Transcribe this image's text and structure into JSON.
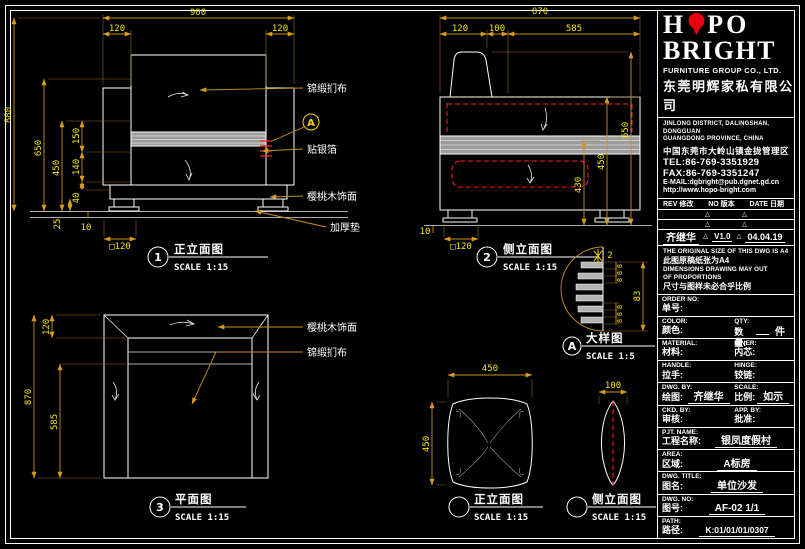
{
  "colors": {
    "background": "#000000",
    "line": "#ffffff",
    "dimension_text": "#f5e400",
    "dimension_line": "#c9921c",
    "hidden_line": "#ff2222",
    "band_gray": "#b3b3b3",
    "logo_red": "#e8000d",
    "detail_marker": "#ffd400"
  },
  "brand": {
    "logo_left": "H",
    "logo_right": "PO",
    "logo_line2": "BRIGHT",
    "company_en": "FURNITURE GROUP CO., LTD.",
    "company_cn": "东莞明辉家私有限公司"
  },
  "contact": {
    "addr_en1": "JINLONG DISTRICT, DALINGSHAN, DONGGUAN",
    "addr_en2": "GUANGDONG PROVINCE, CHINA",
    "addr_cn": "中国东莞市大岭山镇金拢管理区",
    "tel": "TEL:86-769-3351929",
    "fax": "FAX:86-769-3351247",
    "email": "E-MAIL:dgbright@pub.dgnet.gd.cn",
    "web": "http://www.hopo-bright.com"
  },
  "revision": {
    "header_rev": "REV 修改",
    "header_no": "NO 版本",
    "header_date": "DATE 日期",
    "name": "齐继华",
    "version": "V1.0",
    "date": "04.04.19"
  },
  "notes": {
    "en1": "THE ORIGINAL SIZE OF THIS DWG IS A4",
    "cn1": "此图原稿纸张为A4",
    "en2": "DIMENSIONS DRAWING MAY OUT",
    "en3": "OF PROPORTIONS",
    "cn2": "尺寸与图样未必合乎比例"
  },
  "tb": {
    "rows": [
      {
        "en": "ORDER NO:",
        "cn": "单号:",
        "value": ""
      },
      {
        "en": "COLOR:",
        "cn": "颜色:",
        "value": "",
        "en2": "QTY:",
        "cn2": "数量:",
        "value2": "件"
      },
      {
        "en": "MATERIAL:",
        "cn": "材料:",
        "value": "",
        "en2": "INNER:",
        "cn2": "内芯:",
        "value2": ""
      },
      {
        "en": "HANDLE:",
        "cn": "拉手:",
        "value": "",
        "en2": "HINGE:",
        "cn2": "铰链:",
        "value2": ""
      },
      {
        "en": "DWG. BY:",
        "cn": "绘图:",
        "value": "齐继华",
        "en2": "SCALE:",
        "cn2": "比例:",
        "value2": "如示"
      },
      {
        "en": "CKD. BY:",
        "cn": "审核:",
        "value": "",
        "en2": "APP. BY:",
        "cn2": "批准:",
        "value2": ""
      },
      {
        "en": "PJT. NAME:",
        "cn": "工程名称:",
        "value": "银凤度假村"
      },
      {
        "en": "AREA:",
        "cn": "区域:",
        "value": "A标房"
      },
      {
        "en": "DWG. TITLE:",
        "cn": "图名:",
        "value": "单位沙发"
      },
      {
        "en": "DWG. NO:",
        "cn": "图号:",
        "value": "AF-02  1/1"
      },
      {
        "en": "PATH:",
        "cn": "路径:",
        "value": "K:01/01/01/0307"
      }
    ]
  },
  "labels": {
    "fabric": "锦缎扪布",
    "foil": "贴银箔",
    "veneer": "樱桃木饰面",
    "pad": "加厚垫",
    "veneer2": "樱桃木饰面",
    "fabric2": "锦缎扪布",
    "ref": "A"
  },
  "views": {
    "front": {
      "num": "1",
      "title": "正立面图",
      "scale": "SCALE 1:15",
      "dims": {
        "w900": "900",
        "w120l": "120",
        "w120r": "120",
        "h880": "880",
        "h650": "650",
        "h450": "450",
        "h150": "150",
        "h140": "140",
        "h40": "40",
        "h25": "25",
        "h10": "10",
        "foot": "□120"
      }
    },
    "side": {
      "num": "2",
      "title": "侧立面图",
      "scale": "SCALE 1:15",
      "dims": {
        "d870": "870",
        "d120": "120",
        "d100": "100",
        "d585": "585",
        "h430": "430",
        "h450": "450",
        "h650": "650",
        "h10": "10",
        "foot": "□120"
      }
    },
    "detail": {
      "num": "A",
      "title": "大样图",
      "scale": "SCALE 1:5",
      "dims": {
        "gap2": "2",
        "e1": "8",
        "e2": "8",
        "e3": "8",
        "e4": "8",
        "e5": "8",
        "e6": "8",
        "total83": "83"
      }
    },
    "plan": {
      "num": "3",
      "title": "平面图",
      "scale": "SCALE 1:15",
      "dims": {
        "d120": "120",
        "d870": "870",
        "d585": "585"
      }
    },
    "cushionF": {
      "title": "正立面图",
      "scale": "SCALE 1:15",
      "dims": {
        "w450": "450",
        "h450": "450"
      }
    },
    "cushionS": {
      "title": "侧立面图",
      "scale": "SCALE 1:15",
      "dims": {
        "w100": "100"
      }
    }
  }
}
